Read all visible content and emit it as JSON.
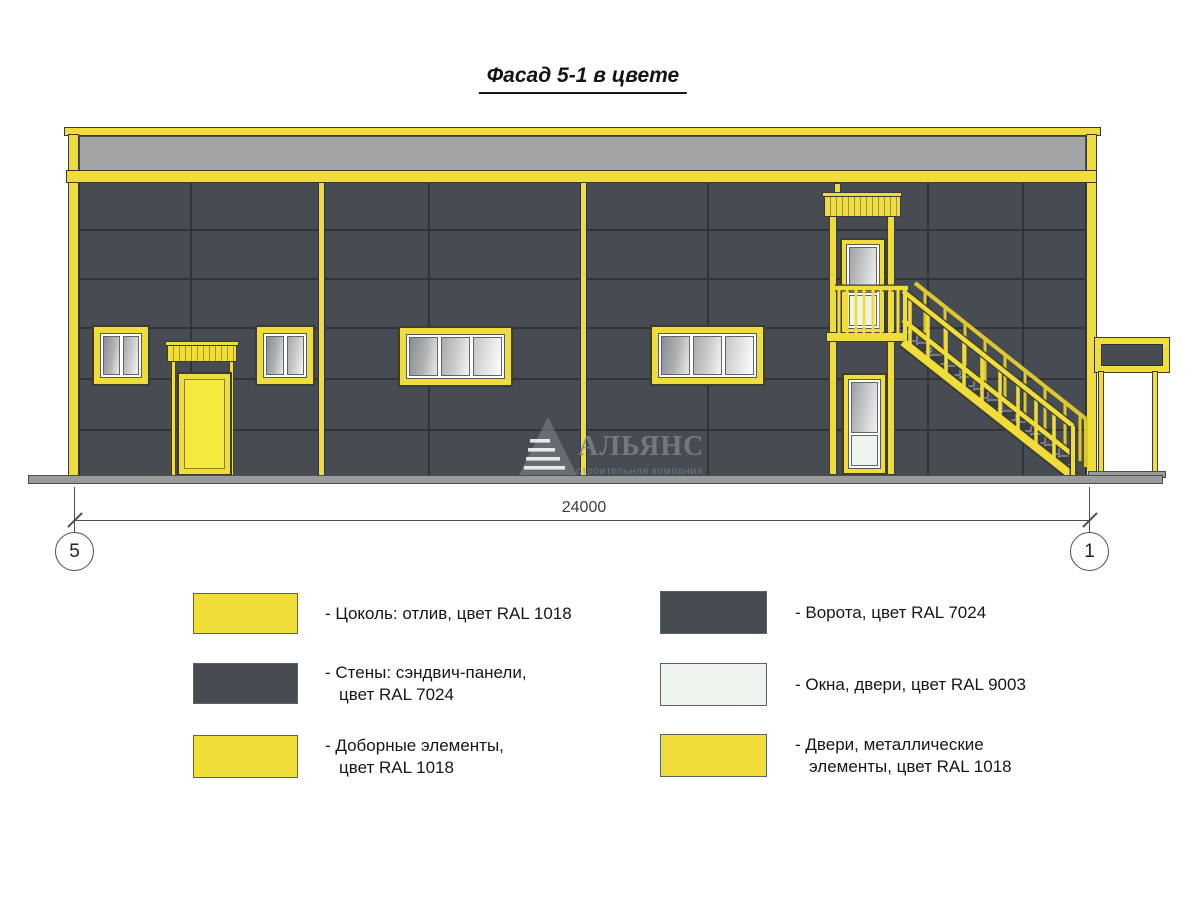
{
  "title": "Фасад 5-1 в цвете",
  "colors": {
    "yellow": "#F1DD3A",
    "yellow_bright": "#F6E93E",
    "yellow_dim": "#DCC92F",
    "wall": "#474B52",
    "seam": "#30343A",
    "parapet": "#A2A4A6",
    "ground": "#9A9C9B",
    "glass_light": "#EDF4EE",
    "outline": "#3B3C35",
    "line": "#4F4F50"
  },
  "dimension": {
    "length_label": "24000",
    "axis_left": "5",
    "axis_right": "1"
  },
  "watermark": {
    "name": "АЛЬЯНС",
    "subtitle": "строительная компания"
  },
  "legend": {
    "items_left": [
      {
        "swatch": "yellow",
        "label": "- Цоколь: отлив, цвет RAL 1018"
      },
      {
        "swatch": "dark",
        "label": "- Стены: сэндвич-панели,\nцвет RAL 7024"
      },
      {
        "swatch": "yellow",
        "label": "- Доборные элементы,\nцвет RAL 1018"
      }
    ],
    "items_right": [
      {
        "swatch": "dark",
        "label": "- Ворота, цвет RAL 7024"
      },
      {
        "swatch": "white",
        "label": "- Окна, двери, цвет RAL 9003"
      },
      {
        "swatch": "yellow",
        "label": "- Двери, металлические\nэлементы, цвет RAL 1018"
      }
    ]
  }
}
